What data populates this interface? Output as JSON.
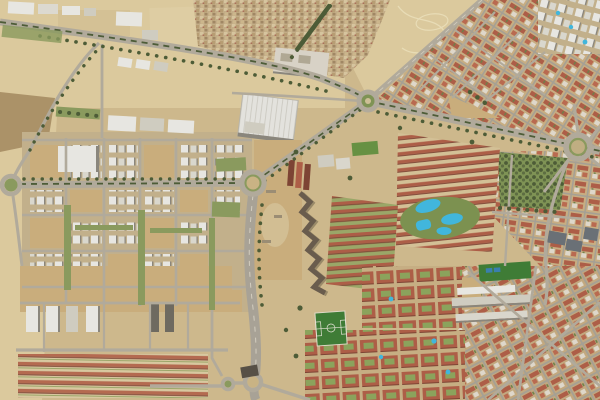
{
  "meta": {
    "view": "satellite-aerial-imagery",
    "description": "Aerial satellite view of a city edge district: dense old town and red-roofed apartment grids on the right, a new development grid with construction lots on the left, tan farm fields, tree-lined avenues, five roundabouts, swimming-pool complexes, football pitches and a zigzag terraced housing complex.",
    "width_px": 600,
    "height_px": 400
  },
  "palette": {
    "ground": "#cdb88c",
    "fieldLight": "#dbc99d",
    "fieldDark": "#ab9268",
    "dirt": "#c9ad7c",
    "road": "#b1aa9b",
    "roadWide": "#a8a296",
    "treeDark": "#4d5c37",
    "grass": "#7f9355",
    "lawn": "#8a9a5e",
    "redRoof": "#ad5e47",
    "redRoofDark": "#7d4434",
    "whiteBldg": "#e7e6e1",
    "greyBldg": "#cfccc0",
    "oldTown": "#c3ad87",
    "pool": "#41b6dc",
    "pitch": "#3f7c36",
    "court": "#3a7fae",
    "zigzag": "#695c4d",
    "darkRoof": "#6a7076",
    "trackLine": "#e8dcb6",
    "shadow": "#8a867c"
  },
  "features": [
    {
      "name": "farm-fields",
      "kind": "agricultural land, top-left and left edge"
    },
    {
      "name": "old-town-district",
      "kind": "dense low-rise housing, top-center"
    },
    {
      "name": "dirt-track-field",
      "kind": "open field with curving trails, top-right"
    },
    {
      "name": "exhibition-hall",
      "kind": "large white ribbed-roof building, center-top"
    },
    {
      "name": "north-roundabout",
      "kind": "roundabout at avenue junction"
    },
    {
      "name": "central-roundabout",
      "kind": "large roundabout, image center-left"
    },
    {
      "name": "east-roundabout",
      "kind": "large roundabout with radiating streets, right edge"
    },
    {
      "name": "west-roundabout",
      "kind": "roundabout, left edge"
    },
    {
      "name": "south-roundabout-pair",
      "kind": "double roundabout interchange, bottom center"
    },
    {
      "name": "tree-lined-avenues",
      "kind": "dual carriageways with green medians"
    },
    {
      "name": "north-south-highway",
      "kind": "wide multi-lane road through center"
    },
    {
      "name": "new-development-grid",
      "kind": "white apartment blocks and construction lots, left"
    },
    {
      "name": "red-roof-apartment-rows",
      "kind": "parallel terracotta apartment slabs, center-right"
    },
    {
      "name": "swimming-pool-complex",
      "kind": "large blue pools in green gardens"
    },
    {
      "name": "rooftop-pool-towers",
      "kind": "white towers with small pools, top-right corner"
    },
    {
      "name": "zigzag-terraced-housing",
      "kind": "dark zigzag housing chain, center"
    },
    {
      "name": "courtyard-housing-blocks",
      "kind": "red blocks with green courtyards, bottom"
    },
    {
      "name": "football-pitch",
      "kind": "green sports field, bottom center"
    },
    {
      "name": "mini-pitch-with-courts",
      "kind": "sports ground with two blue courts, bottom right"
    },
    {
      "name": "city-park",
      "kind": "dense tree park, center-right"
    },
    {
      "name": "school-buildings",
      "kind": "long light institutional buildings"
    },
    {
      "name": "warehouses",
      "kind": "white industrial sheds, top-left"
    }
  ]
}
